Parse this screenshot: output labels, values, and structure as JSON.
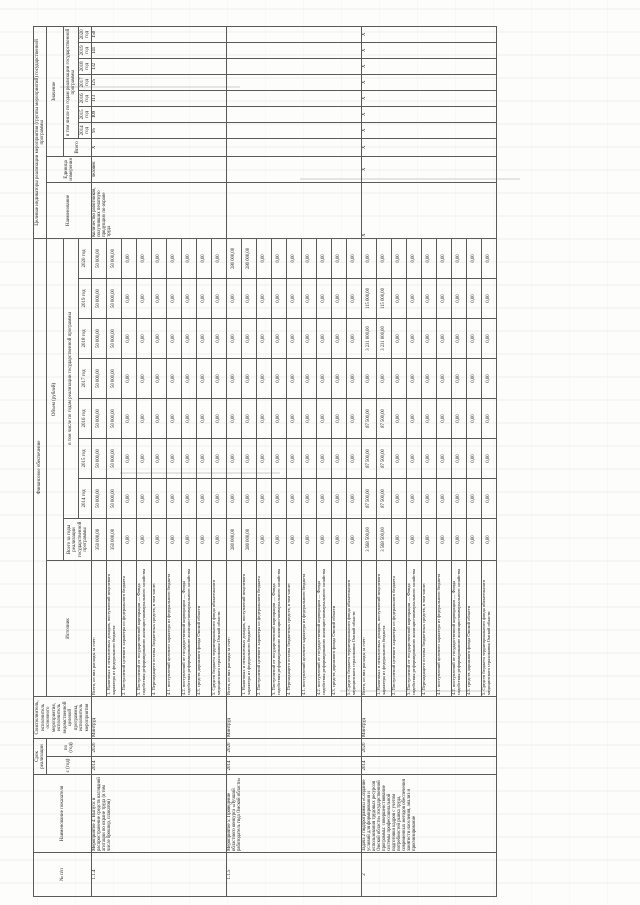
{
  "header": {
    "num": "№ п/п",
    "name": "Наименование показателя",
    "term": "Срок реализации",
    "term_from": "с (год)",
    "term_to": "по (год)",
    "executor": "Соисполнитель, исполнитель основного мероприятия, исполнитель ведомственной целевой программы, исполнитель мероприятия",
    "fin_group": "Финансовое обеспечение",
    "source": "Источник",
    "volume": "Объем (рублей)",
    "total_years": "Всего за годы реализации государственной программы",
    "by_years": "в том числе по годам реализации государственной программы",
    "ind_group": "Целевые индикаторы реализации мероприятия (группы мероприятий) государственной программы",
    "ind_name": "Наименование",
    "ind_unit": "Единица измерения",
    "ind_value": "Значение",
    "ind_total": "Всего",
    "years": [
      "2014 год",
      "2015 год",
      "2016 год",
      "2017 год",
      "2018 год",
      "2019 год",
      "2020 год"
    ]
  },
  "financing_sources": [
    "Всего, из них расходы за счет:",
    "1. Налоговых и неналоговых доходов, поступлений нецелевого характера из федерального бюджета",
    "2. Поступлений целевого характера из федерального бюджета",
    "3. Поступлений от государственной корпорации — Фонда содействия реформированию жилищно-коммунального хозяйства",
    "4. Переходящего остатка бюджетных средств, в том числе:",
    "4.1. поступлений целевого характера из федерального бюджета",
    "4.2. поступлений от государственной корпорации — Фонда содействия реформированию жилищно-коммунального хозяйства",
    "4.3. средств дорожного фонда Омской области",
    "5. Средств бюджета территориального фонда обязательного медицинского страхования Омской области"
  ],
  "rows": [
    {
      "num": "1.1.4",
      "name": "Мероприятие 4: Выпуск и распространение средств наглядной агитации по охране труда (в том числе брошюр, плакатов)",
      "from": "2014",
      "to": "2020",
      "executor": "Минтруд",
      "financing": [
        [
          "350 000,00",
          "50 000,00",
          "50 000,00",
          "50 000,00",
          "50 000,00",
          "50 000,00",
          "50 000,00",
          "50 000,00"
        ],
        [
          "350 000,00",
          "50 000,00",
          "50 000,00",
          "50 000,00",
          "50 000,00",
          "50 000,00",
          "50 000,00",
          "50 000,00"
        ],
        [
          "0,00",
          "0,00",
          "0,00",
          "0,00",
          "0,00",
          "0,00",
          "0,00",
          "0,00"
        ],
        [
          "0,00",
          "0,00",
          "0,00",
          "0,00",
          "0,00",
          "0,00",
          "0,00",
          "0,00"
        ],
        [
          "0,00",
          "0,00",
          "0,00",
          "0,00",
          "0,00",
          "0,00",
          "0,00",
          "0,00"
        ],
        [
          "0,00",
          "0,00",
          "0,00",
          "0,00",
          "0,00",
          "0,00",
          "0,00",
          "0,00"
        ],
        [
          "0,00",
          "0,00",
          "0,00",
          "0,00",
          "0,00",
          "0,00",
          "0,00",
          "0,00"
        ],
        [
          "0,00",
          "0,00",
          "0,00",
          "0,00",
          "0,00",
          "0,00",
          "0,00",
          "0,00"
        ],
        [
          "0,00",
          "0,00",
          "0,00",
          "0,00",
          "0,00",
          "0,00",
          "0,00",
          "0,00"
        ]
      ],
      "indicator": {
        "name": "Количество работников, получивших печатную продукцию по охране труда",
        "unit": "человек",
        "values": [
          "Х",
          "95",
          "109",
          "113",
          "125",
          "132",
          "141",
          "150"
        ]
      }
    },
    {
      "num": "1.1.5",
      "name": "Мероприятие 5: Проведение областного конкурса «Лучший работодатель года Омской области»",
      "from": "2014",
      "to": "2020",
      "executor": "Минтруд",
      "financing": [
        [
          "280 000,00",
          "0,00",
          "0,00",
          "0,00",
          "0,00",
          "0,00",
          "0,00",
          "280 000,00"
        ],
        [
          "280 000,00",
          "0,00",
          "0,00",
          "0,00",
          "0,00",
          "0,00",
          "0,00",
          "280 000,00"
        ],
        [
          "0,00",
          "0,00",
          "0,00",
          "0,00",
          "0,00",
          "0,00",
          "0,00",
          "0,00"
        ],
        [
          "0,00",
          "0,00",
          "0,00",
          "0,00",
          "0,00",
          "0,00",
          "0,00",
          "0,00"
        ],
        [
          "0,00",
          "0,00",
          "0,00",
          "0,00",
          "0,00",
          "0,00",
          "0,00",
          "0,00"
        ],
        [
          "0,00",
          "0,00",
          "0,00",
          "0,00",
          "0,00",
          "0,00",
          "0,00",
          "0,00"
        ],
        [
          "0,00",
          "0,00",
          "0,00",
          "0,00",
          "0,00",
          "0,00",
          "0,00",
          "0,00"
        ],
        [
          "0,00",
          "0,00",
          "0,00",
          "0,00",
          "0,00",
          "0,00",
          "0,00",
          "0,00"
        ],
        [
          "0,00",
          "0,00",
          "0,00",
          "0,00",
          "0,00",
          "0,00",
          "0,00",
          "0,00"
        ]
      ],
      "indicator": {
        "name": "",
        "unit": "",
        "values": [
          "",
          "",
          "",
          "",
          "",
          "",
          "",
          ""
        ]
      }
    },
    {
      "num": "2",
      "name": "Задача 2 подпрограммы «Создание условий для формирования и использования трудовых ресурсов Омской области» государственной программы: совершенствование системы профессиональной подготовки кадров с учетом потребностей рынка труда, современных методов обеспечения занятости населения, анализ и прогнозирование",
      "from": "2014",
      "to": "2020",
      "executor": "Минтруд",
      "financing": [
        [
          "3 568 500,00",
          "87 500,00",
          "87 500,00",
          "87 500,00",
          "0,00",
          "3 231 000,00",
          "115 000,00",
          "0,00"
        ],
        [
          "3 568 500,00",
          "87 500,00",
          "87 500,00",
          "87 500,00",
          "0,00",
          "3 231 000,00",
          "115 000,00",
          "0,00"
        ],
        [
          "0,00",
          "0,00",
          "0,00",
          "0,00",
          "0,00",
          "0,00",
          "0,00",
          "0,00"
        ],
        [
          "0,00",
          "0,00",
          "0,00",
          "0,00",
          "0,00",
          "0,00",
          "0,00",
          "0,00"
        ],
        [
          "0,00",
          "0,00",
          "0,00",
          "0,00",
          "0,00",
          "0,00",
          "0,00",
          "0,00"
        ],
        [
          "0,00",
          "0,00",
          "0,00",
          "0,00",
          "0,00",
          "0,00",
          "0,00",
          "0,00"
        ],
        [
          "0,00",
          "0,00",
          "0,00",
          "0,00",
          "0,00",
          "0,00",
          "0,00",
          "0,00"
        ],
        [
          "0,00",
          "0,00",
          "0,00",
          "0,00",
          "0,00",
          "0,00",
          "0,00",
          "0,00"
        ],
        [
          "0,00",
          "0,00",
          "0,00",
          "0,00",
          "0,00",
          "0,00",
          "0,00",
          "0,00"
        ]
      ],
      "indicator": {
        "name": "Х",
        "unit": "Х",
        "values": [
          "Х",
          "Х",
          "Х",
          "Х",
          "Х",
          "Х",
          "Х",
          "Х"
        ]
      }
    }
  ]
}
